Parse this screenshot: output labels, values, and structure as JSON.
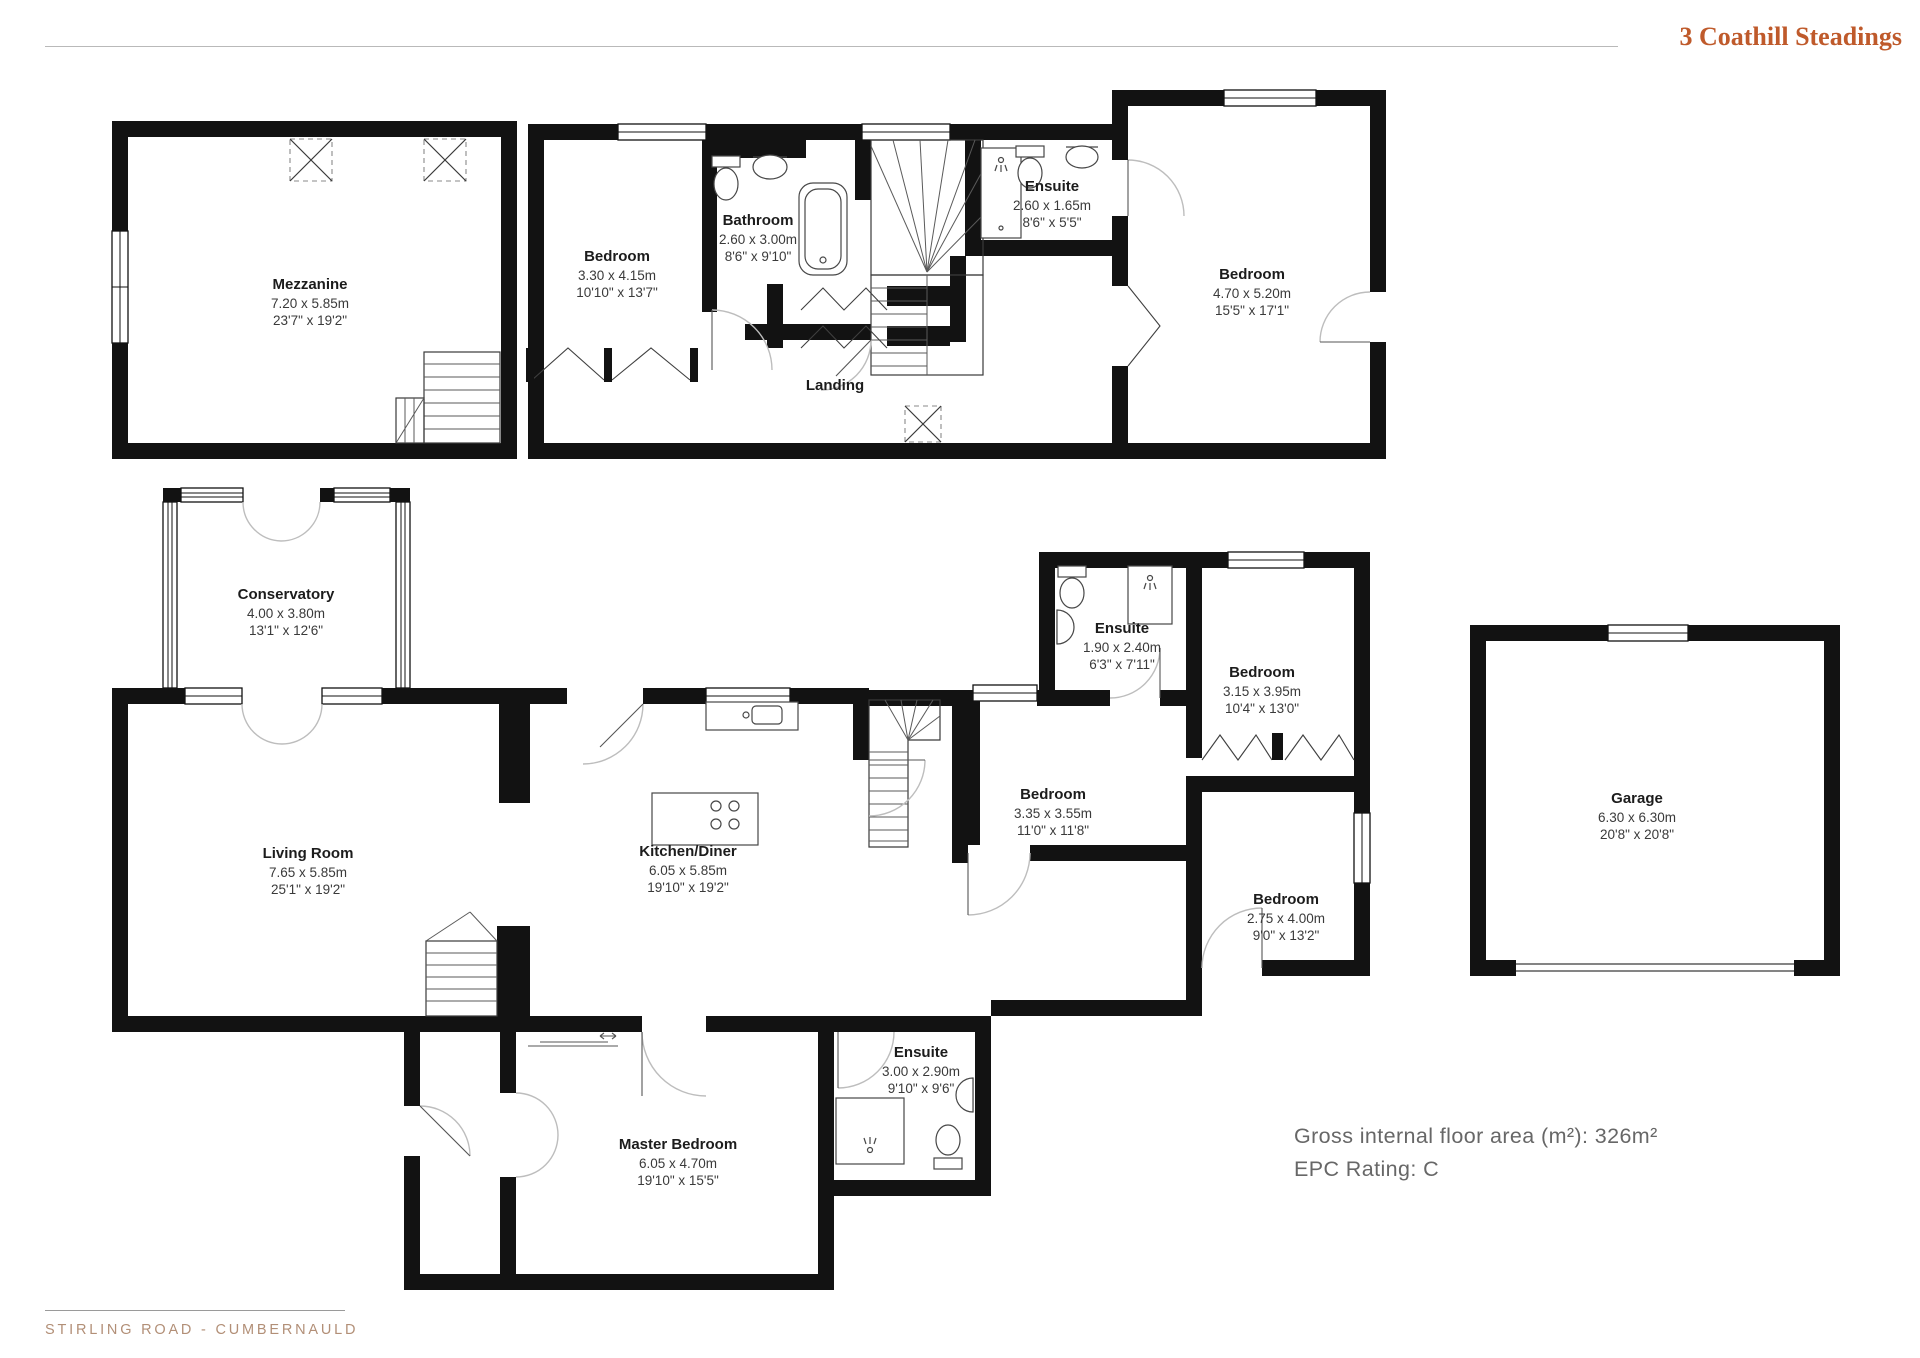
{
  "header": {
    "title": "3 Coathill Steadings"
  },
  "summary": {
    "floor_area": "Gross internal floor area (m²): 326m²",
    "epc": "EPC Rating: C"
  },
  "footer": {
    "address": "STIRLING ROAD - CUMBERNAULD"
  },
  "colors": {
    "accent": "#bf5a2b",
    "footer_text": "#b28f77",
    "summary_text": "#676767",
    "wall": "#121212"
  },
  "rooms": {
    "mezzanine": {
      "name": "Mezzanine",
      "metric": "7.20 x 5.85m",
      "imperial": "23'7\" x 19'2\""
    },
    "bedroom1": {
      "name": "Bedroom",
      "metric": "3.30 x 4.15m",
      "imperial": "10'10\" x 13'7\""
    },
    "bathroom": {
      "name": "Bathroom",
      "metric": "2.60 x 3.00m",
      "imperial": "8'6\" x 9'10\""
    },
    "ensuite1": {
      "name": "Ensuite",
      "metric": "2.60 x 1.65m",
      "imperial": "8'6\" x 5'5\""
    },
    "bedroom2": {
      "name": "Bedroom",
      "metric": "4.70 x 5.20m",
      "imperial": "15'5\" x 17'1\""
    },
    "landing": {
      "name": "Landing"
    },
    "conservatory": {
      "name": "Conservatory",
      "metric": "4.00 x 3.80m",
      "imperial": "13'1\" x 12'6\""
    },
    "living_room": {
      "name": "Living Room",
      "metric": "7.65 x 5.85m",
      "imperial": "25'1\" x 19'2\""
    },
    "kitchen_diner": {
      "name": "Kitchen/Diner",
      "metric": "6.05 x 5.85m",
      "imperial": "19'10\" x 19'2\""
    },
    "ensuite2": {
      "name": "Ensuite",
      "metric": "1.90 x 2.40m",
      "imperial": "6'3\" x 7'11\""
    },
    "bedroom3": {
      "name": "Bedroom",
      "metric": "3.15 x 3.95m",
      "imperial": "10'4\" x 13'0\""
    },
    "bedroom4": {
      "name": "Bedroom",
      "metric": "3.35 x 3.55m",
      "imperial": "11'0\" x 11'8\""
    },
    "bedroom5": {
      "name": "Bedroom",
      "metric": "2.75 x 4.00m",
      "imperial": "9'0\" x 13'2\""
    },
    "ensuite3": {
      "name": "Ensuite",
      "metric": "3.00 x 2.90m",
      "imperial": "9'10\" x 9'6\""
    },
    "master_bedroom": {
      "name": "Master Bedroom",
      "metric": "6.05 x 4.70m",
      "imperial": "19'10\" x 15'5\""
    },
    "garage": {
      "name": "Garage",
      "metric": "6.30 x 6.30m",
      "imperial": "20'8\" x 20'8\""
    }
  }
}
